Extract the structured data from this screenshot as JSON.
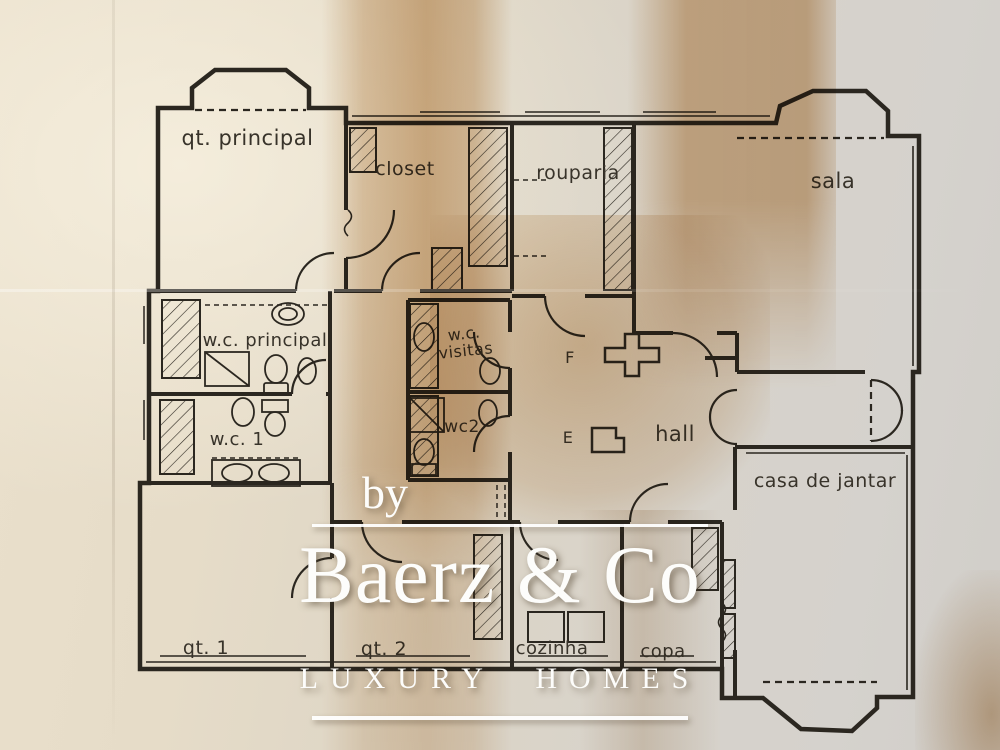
{
  "plan": {
    "rooms": {
      "qt_principal": {
        "label": "qt. principal"
      },
      "closet": {
        "label": "closet"
      },
      "rouparia": {
        "label": "rouparia"
      },
      "sala": {
        "label": "sala"
      },
      "wc_principal": {
        "label": "w.c. principal"
      },
      "wc_visitas": {
        "label": "w.c. visitas"
      },
      "wc_1": {
        "label": "w.c. 1"
      },
      "wc_2": {
        "label": "wc2"
      },
      "hall": {
        "label": "hall"
      },
      "casa_de_jantar": {
        "label": "casa de jantar"
      },
      "qt_1": {
        "label": "qt. 1"
      },
      "qt_2": {
        "label": "qt. 2"
      },
      "cozinha": {
        "label": "cozinha"
      },
      "copa": {
        "label": "copa"
      }
    },
    "annotations": {
      "f": "F",
      "e": "E"
    }
  },
  "watermark": {
    "prefix": "by",
    "brand": "Baerz & Co",
    "tagline": "LUXURY HOMES"
  },
  "colors": {
    "ink": "#2b2720",
    "paper_light": "#eae0cc",
    "paper_gray": "#d1cec9",
    "stain_tan": "#ba8240",
    "watermark": "#fdfdfb"
  }
}
